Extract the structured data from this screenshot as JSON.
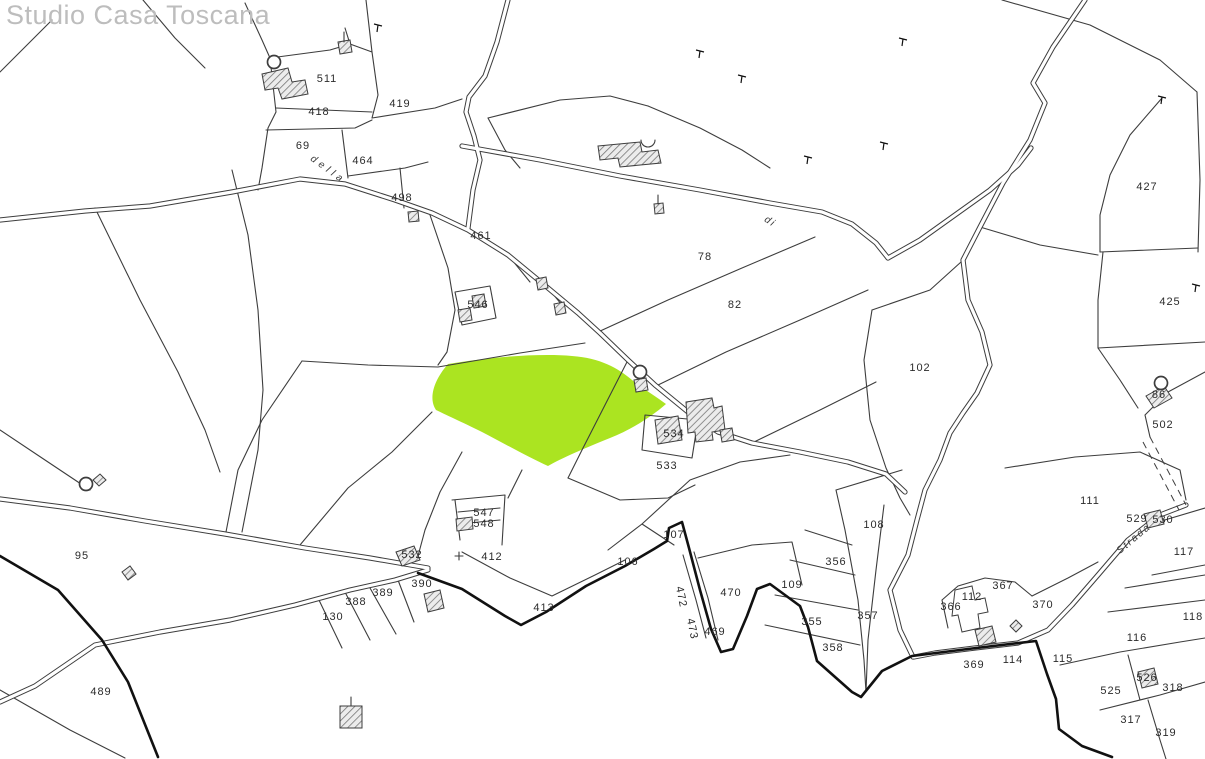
{
  "watermark": {
    "text": "Studio Casa Toscana"
  },
  "colors": {
    "background": "#ffffff",
    "line": "#3d3d3d",
    "thick_line": "#111111",
    "highlight_parcel": "#abe421",
    "watermark": "#bdbdbd",
    "hatch": "#777777"
  },
  "highlighted_parcel": {
    "description": "green-highlighted parcel in map center"
  },
  "parcel_labels": [
    {
      "text": "511",
      "x": 327,
      "y": 79
    },
    {
      "text": "418",
      "x": 319,
      "y": 112
    },
    {
      "text": "419",
      "x": 400,
      "y": 104
    },
    {
      "text": "69",
      "x": 303,
      "y": 146
    },
    {
      "text": "464",
      "x": 363,
      "y": 161
    },
    {
      "text": "498",
      "x": 402,
      "y": 198
    },
    {
      "text": "461",
      "x": 481,
      "y": 236
    },
    {
      "text": "546",
      "x": 478,
      "y": 305
    },
    {
      "text": "78",
      "x": 705,
      "y": 257
    },
    {
      "text": "82",
      "x": 735,
      "y": 305
    },
    {
      "text": "427",
      "x": 1147,
      "y": 187
    },
    {
      "text": "425",
      "x": 1170,
      "y": 302
    },
    {
      "text": "102",
      "x": 920,
      "y": 368
    },
    {
      "text": "86",
      "x": 1159,
      "y": 395
    },
    {
      "text": "502",
      "x": 1163,
      "y": 425
    },
    {
      "text": "534",
      "x": 674,
      "y": 434
    },
    {
      "text": "533",
      "x": 667,
      "y": 466
    },
    {
      "text": "111",
      "x": 1090,
      "y": 501
    },
    {
      "text": "529",
      "x": 1137,
      "y": 519
    },
    {
      "text": "530",
      "x": 1163,
      "y": 520
    },
    {
      "text": "117",
      "x": 1184,
      "y": 552
    },
    {
      "text": "95",
      "x": 82,
      "y": 556
    },
    {
      "text": "547",
      "x": 484,
      "y": 513
    },
    {
      "text": "548",
      "x": 484,
      "y": 524
    },
    {
      "text": "412",
      "x": 492,
      "y": 557
    },
    {
      "text": "532",
      "x": 412,
      "y": 555
    },
    {
      "text": "390",
      "x": 422,
      "y": 584
    },
    {
      "text": "389",
      "x": 383,
      "y": 593
    },
    {
      "text": "388",
      "x": 356,
      "y": 602
    },
    {
      "text": "130",
      "x": 333,
      "y": 617
    },
    {
      "text": "413",
      "x": 544,
      "y": 608
    },
    {
      "text": "106",
      "x": 628,
      "y": 562
    },
    {
      "text": "107",
      "x": 674,
      "y": 535
    },
    {
      "text": "470",
      "x": 731,
      "y": 593
    },
    {
      "text": "472",
      "x": 681,
      "y": 597,
      "rot": 78
    },
    {
      "text": "473",
      "x": 692,
      "y": 629,
      "rot": 78
    },
    {
      "text": "469",
      "x": 715,
      "y": 632
    },
    {
      "text": "108",
      "x": 874,
      "y": 525
    },
    {
      "text": "356",
      "x": 836,
      "y": 562
    },
    {
      "text": "109",
      "x": 792,
      "y": 585
    },
    {
      "text": "355",
      "x": 812,
      "y": 622
    },
    {
      "text": "357",
      "x": 868,
      "y": 616
    },
    {
      "text": "358",
      "x": 833,
      "y": 648
    },
    {
      "text": "367",
      "x": 1003,
      "y": 586
    },
    {
      "text": "112",
      "x": 972,
      "y": 597
    },
    {
      "text": "366",
      "x": 951,
      "y": 607
    },
    {
      "text": "370",
      "x": 1043,
      "y": 605
    },
    {
      "text": "369",
      "x": 974,
      "y": 665
    },
    {
      "text": "114",
      "x": 1013,
      "y": 660
    },
    {
      "text": "115",
      "x": 1063,
      "y": 659
    },
    {
      "text": "116",
      "x": 1137,
      "y": 638
    },
    {
      "text": "118",
      "x": 1193,
      "y": 617
    },
    {
      "text": "525",
      "x": 1111,
      "y": 691
    },
    {
      "text": "526",
      "x": 1147,
      "y": 678
    },
    {
      "text": "318",
      "x": 1173,
      "y": 688
    },
    {
      "text": "317",
      "x": 1131,
      "y": 720
    },
    {
      "text": "319",
      "x": 1166,
      "y": 733
    },
    {
      "text": "489",
      "x": 101,
      "y": 692
    }
  ],
  "street_labels": [
    {
      "text": "della",
      "x": 328,
      "y": 170,
      "rot": 36,
      "spacing": 4
    },
    {
      "text": "di",
      "x": 770,
      "y": 222,
      "rot": 33,
      "spacing": 2
    },
    {
      "text": "Strada",
      "x": 1134,
      "y": 539,
      "rot": -40,
      "spacing": 2
    }
  ]
}
